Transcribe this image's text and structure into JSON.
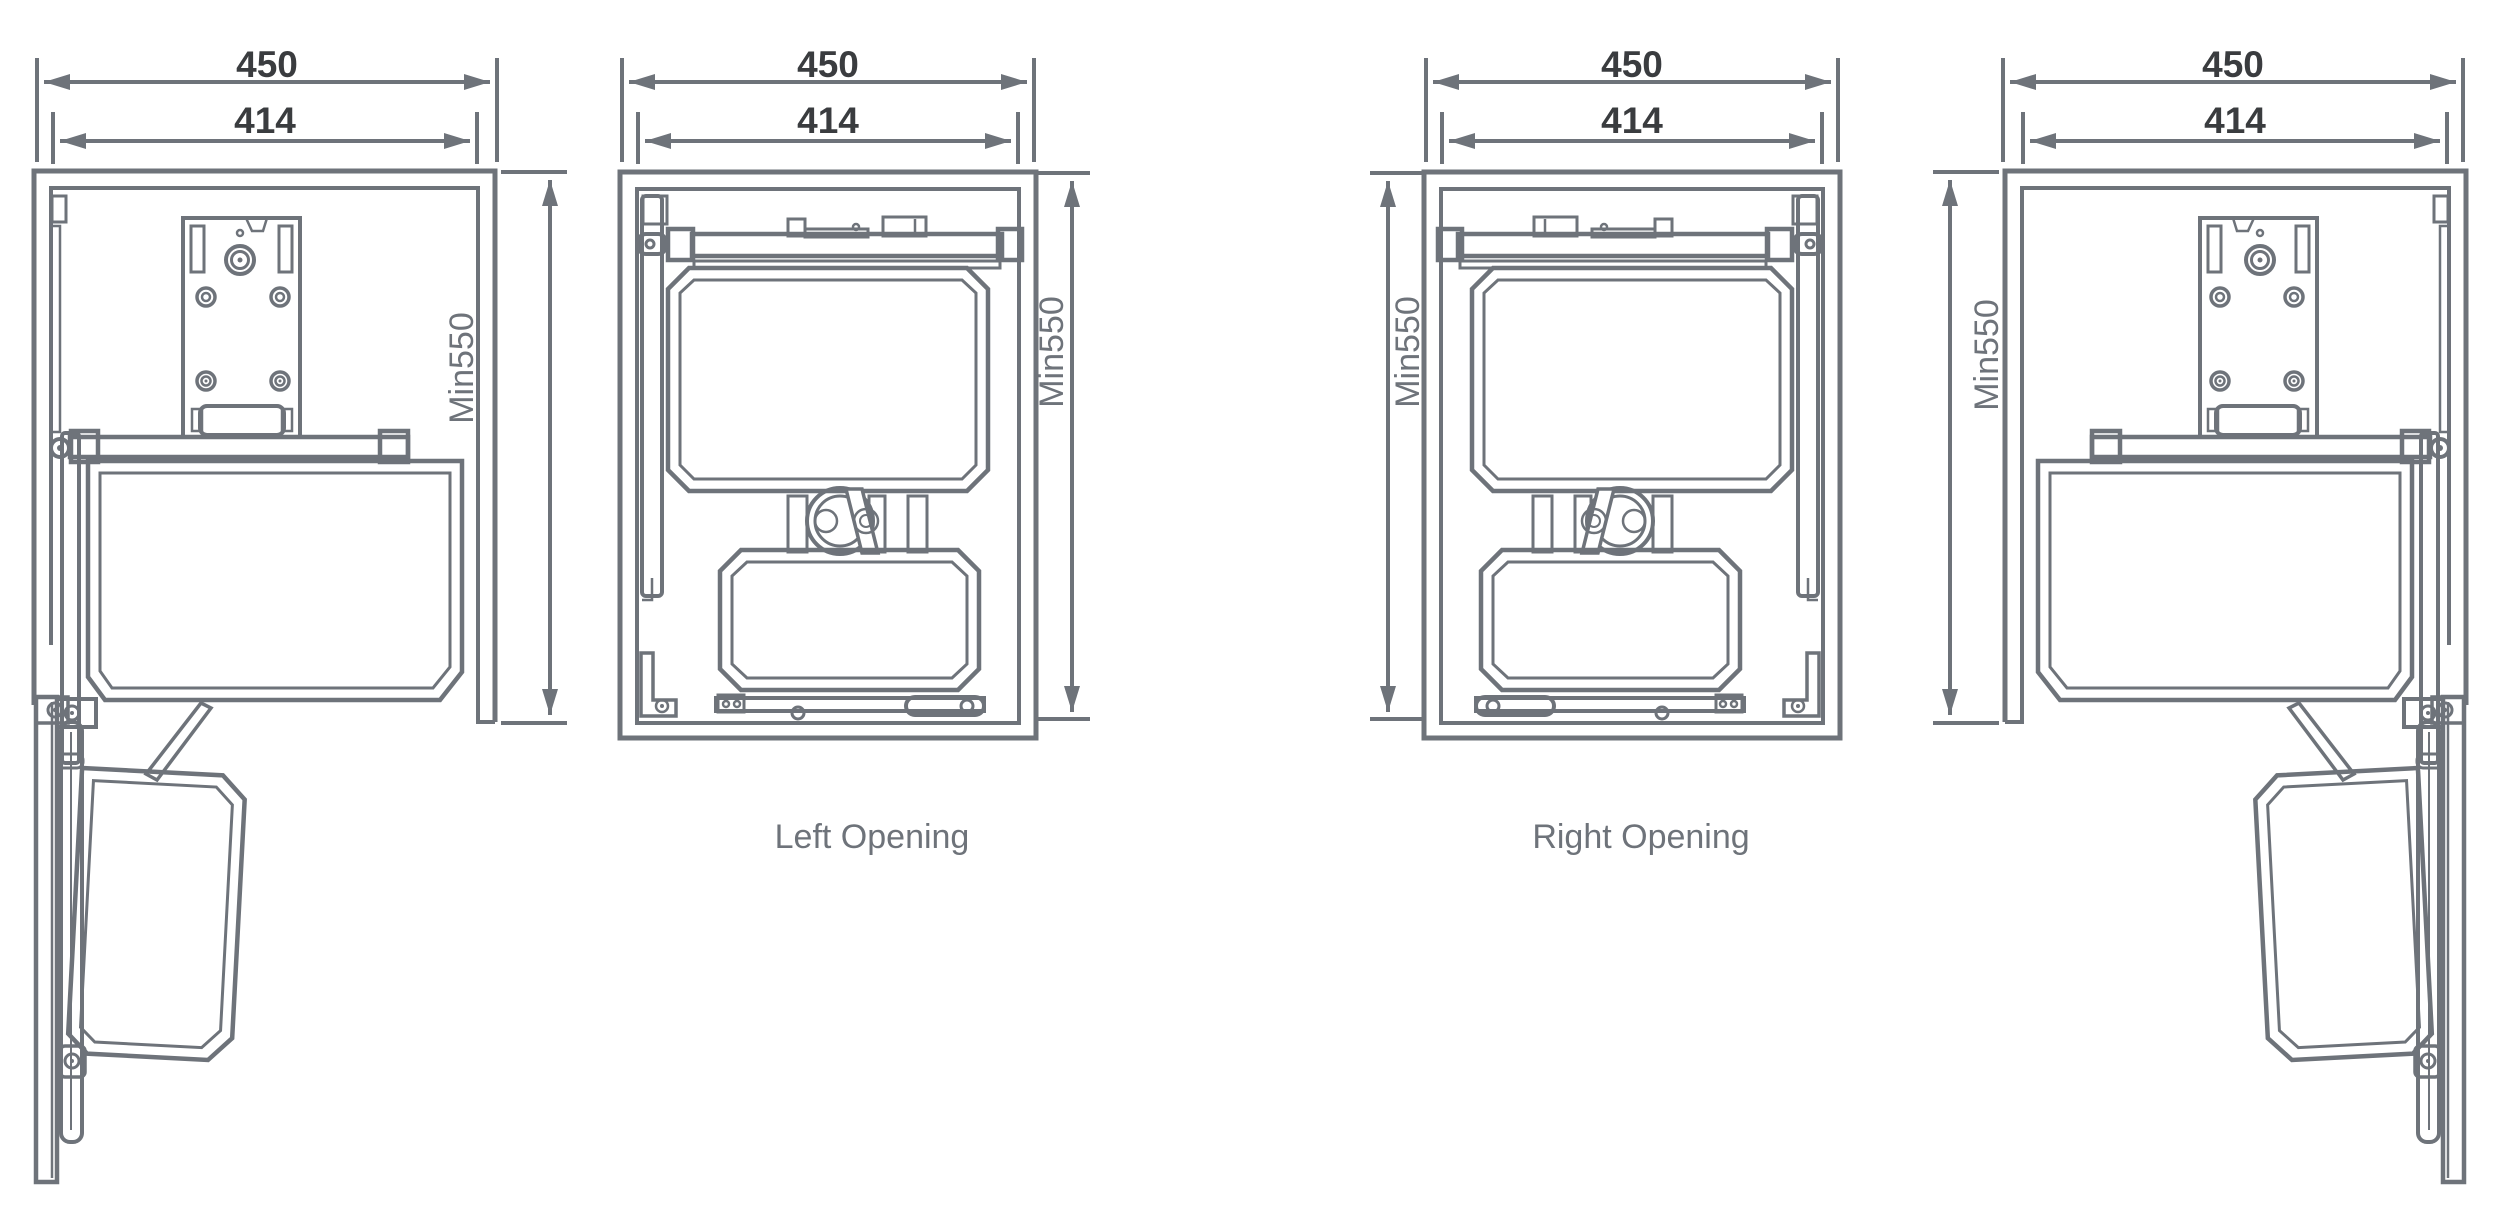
{
  "diagram": {
    "title": "",
    "colors": {
      "background": "#ffffff",
      "line_color": "#6e737a",
      "dim_text_color": "#3a3c3f",
      "label_text_color": "#6e737a"
    },
    "panels": [
      {
        "name": "side-view-door-open-left",
        "dims": {
          "outer": "450",
          "inner": "414",
          "height": "Min550"
        },
        "caption": ""
      },
      {
        "name": "front-view-left-opening",
        "dims": {
          "outer": "450",
          "inner": "414",
          "height": "Min550"
        },
        "caption": "Left Opening"
      },
      {
        "name": "front-view-right-opening",
        "dims": {
          "outer": "450",
          "inner": "414",
          "height": "Min550"
        },
        "caption": "Right Opening"
      },
      {
        "name": "side-view-door-open-right",
        "dims": {
          "outer": "450",
          "inner": "414",
          "height": "Min550"
        },
        "caption": ""
      }
    ]
  }
}
